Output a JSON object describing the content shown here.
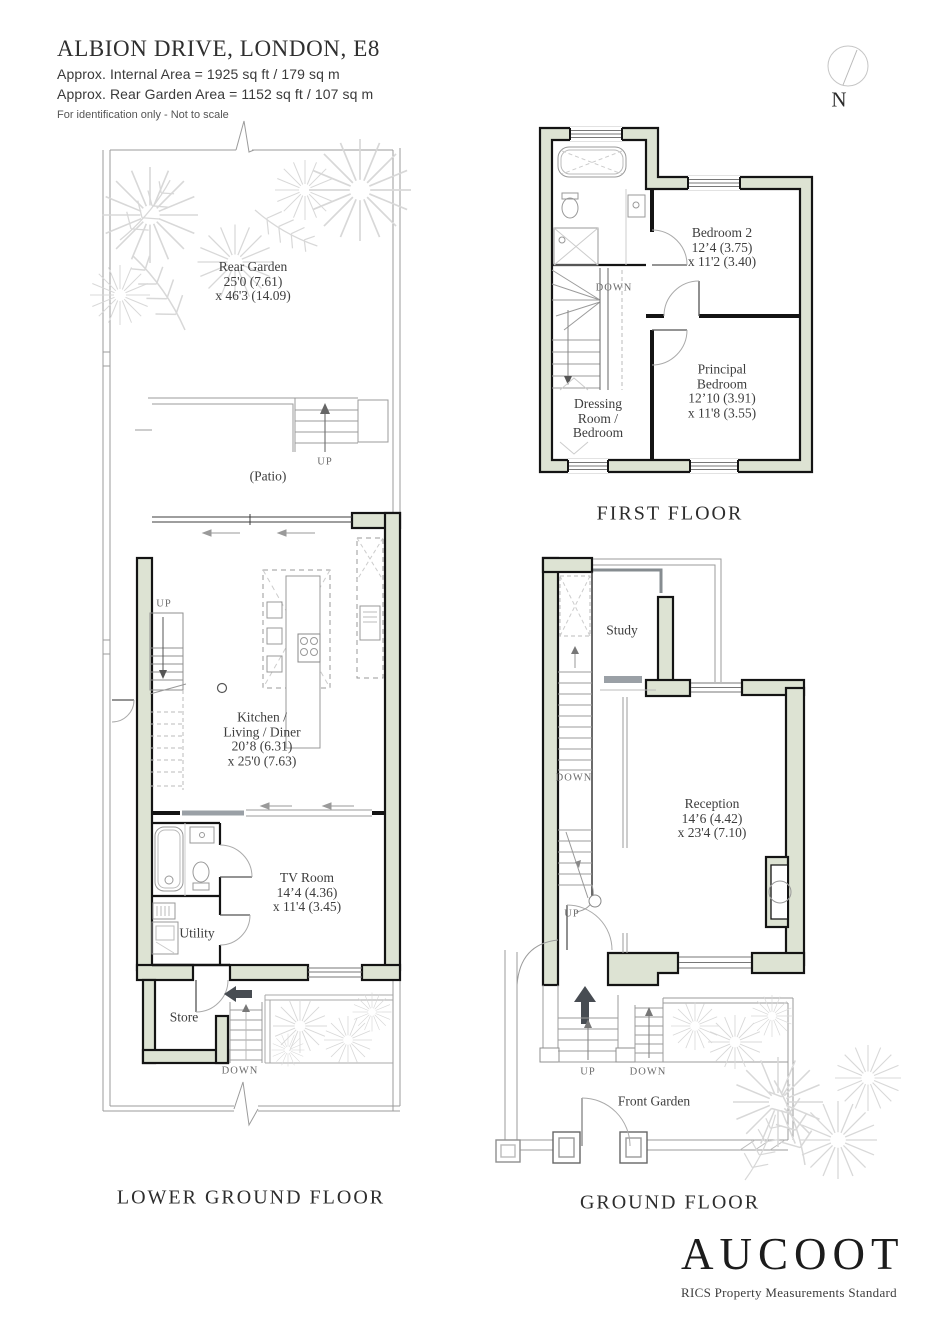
{
  "header": {
    "title": "ALBION DRIVE, LONDON, E8",
    "internal_area": "Approx. Internal Area = 1925 sq ft / 179 sq m",
    "garden_area": "Approx. Rear Garden Area =  1152 sq ft / 107 sq m",
    "disclaimer": "For identification only - Not to scale"
  },
  "compass": {
    "north_label": "N"
  },
  "floors": {
    "lower_ground": {
      "label": "LOWER GROUND FLOOR",
      "rear_garden": {
        "lines": [
          "Rear Garden",
          "25'0 (7.61)",
          "x 46'3 (14.09)"
        ]
      },
      "patio": {
        "lines": [
          "(Patio)"
        ]
      },
      "kitchen": {
        "lines": [
          "Kitchen /",
          "Living / Diner",
          "20’8 (6.31)",
          "x 25'0 (7.63)"
        ]
      },
      "tv_room": {
        "lines": [
          "TV Room",
          "14’4 (4.36)",
          "x 11'4 (3.45)"
        ]
      },
      "utility": {
        "lines": [
          "Utility"
        ]
      },
      "store": {
        "lines": [
          "Store"
        ]
      },
      "patio_stairs_label": "UP",
      "inner_stairs_label": "UP",
      "store_stairs_label": "DOWN"
    },
    "first": {
      "label": "FIRST FLOOR",
      "bedroom2": {
        "lines": [
          "Bedroom 2",
          "12’4 (3.75)",
          "x 11'2 (3.40)"
        ]
      },
      "principal_bedroom": {
        "lines": [
          "Principal",
          "Bedroom",
          "12’10 (3.91)",
          "x 11'8 (3.55)"
        ]
      },
      "dressing_room": {
        "lines": [
          "Dressing",
          "Room /",
          "Bedroom"
        ]
      },
      "stairs_label": "DOWN"
    },
    "ground": {
      "label": "GROUND FLOOR",
      "study": {
        "lines": [
          "Study"
        ]
      },
      "reception": {
        "lines": [
          "Reception",
          "14’6 (4.42)",
          "x 23'4 (7.10)"
        ]
      },
      "front_garden": {
        "lines": [
          "Front Garden"
        ]
      },
      "stairs_down_label": "DOWN",
      "stairs_up_label": "UP",
      "entry_up_label": "UP",
      "entry_down_label": "DOWN"
    }
  },
  "footer": {
    "brand": "AUCOOT",
    "standard": "RICS Property Measurements Standard"
  },
  "colors": {
    "wall_fill": "#dde3d3",
    "wall_stroke": "#141414",
    "thin_line": "#9b9b9b",
    "plant": "#d8d8d8",
    "arrow_dark": "#474c52"
  }
}
